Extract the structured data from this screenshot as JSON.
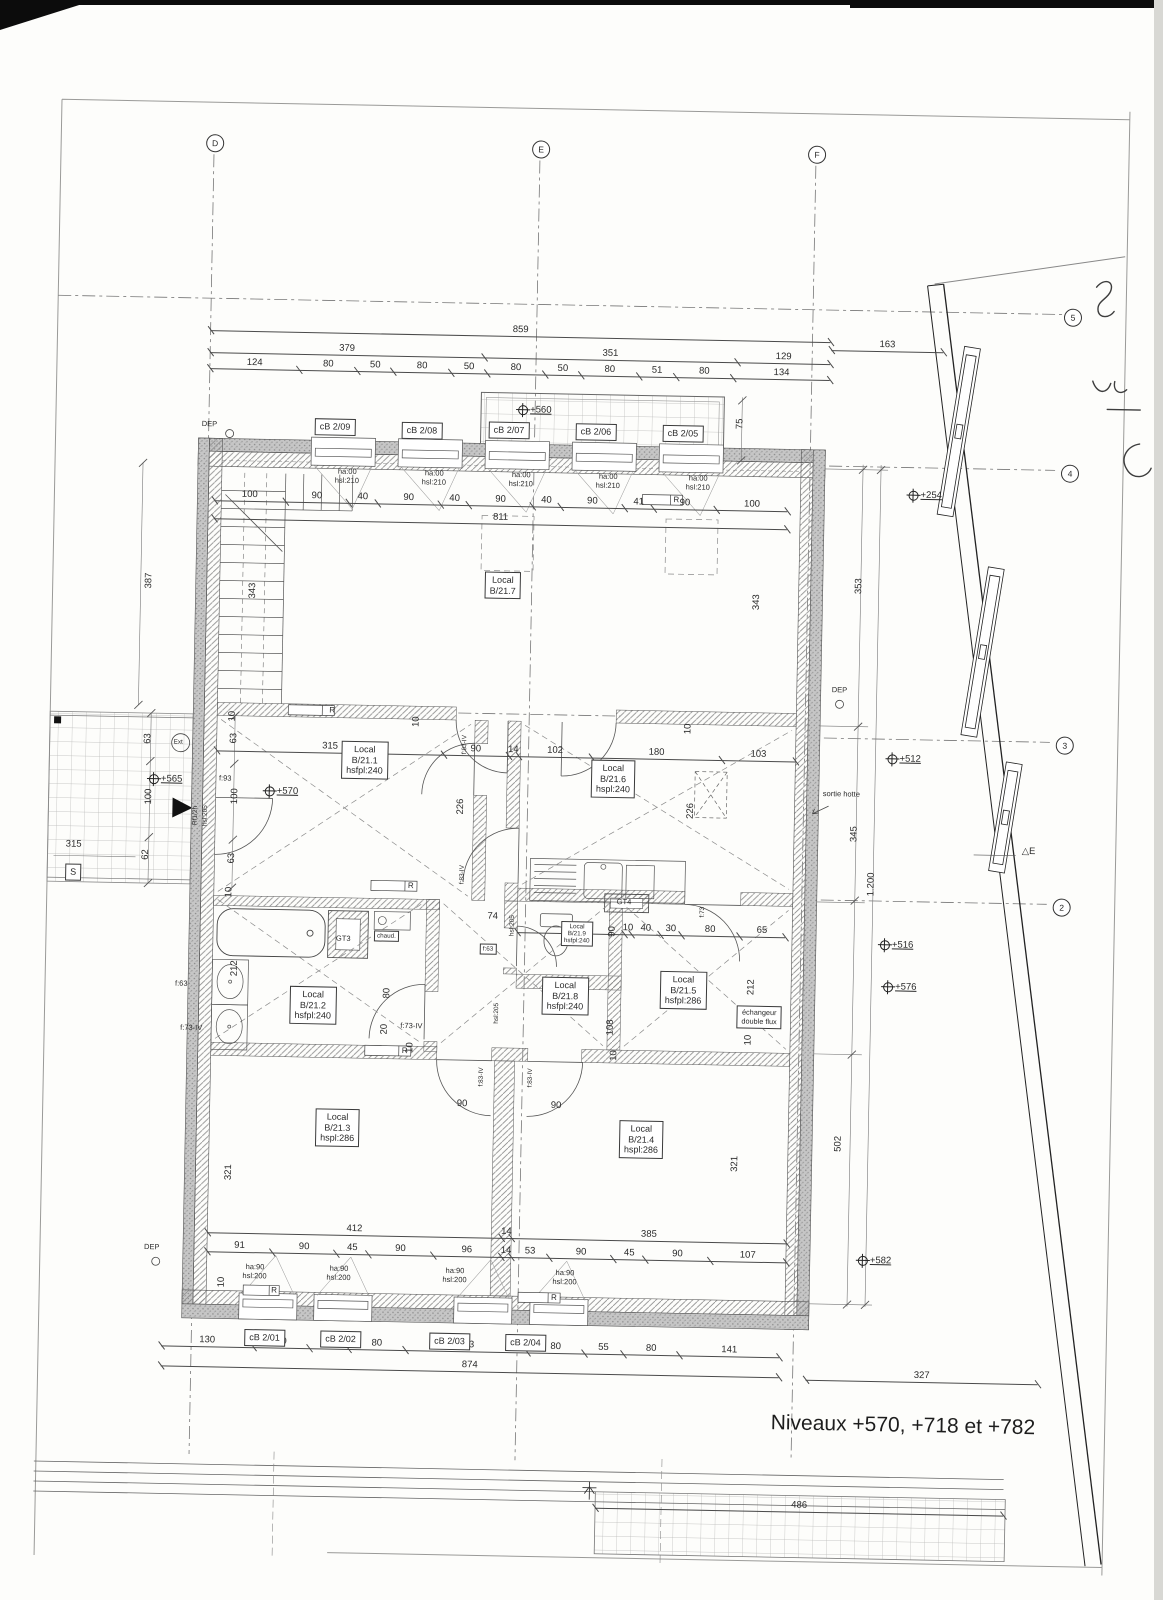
{
  "note": {
    "levels_note": "Niveaux +570, +718 et +782"
  },
  "grid": {
    "d": "D",
    "e": "E",
    "f": "F",
    "r5": "5",
    "r4": "4",
    "r3": "3",
    "r2": "2"
  },
  "levels": {
    "balcony": "+560",
    "facade": "+254",
    "terrace": "+565",
    "entry": "+570",
    "mid": "+512",
    "low1": "+516",
    "low2": "+576",
    "bottom": "+582"
  },
  "rooms": {
    "b217": {
      "l1": "Local",
      "l2": "B/21.7"
    },
    "b211": {
      "l1": "Local",
      "l2": "B/21.1",
      "l3": "hsfpl:240"
    },
    "b216": {
      "l1": "Local",
      "l2": "B/21.6",
      "l3": "hspl:240"
    },
    "b212": {
      "l1": "Local",
      "l2": "B/21.2",
      "l3": "hsfpl:240"
    },
    "b219": {
      "l1": "Local",
      "l2": "B/21.9",
      "l3": "hsfpl:240"
    },
    "b218": {
      "l1": "Local",
      "l2": "B/21.8",
      "l3": "hsfpl:240"
    },
    "b215": {
      "l1": "Local",
      "l2": "B/21.5",
      "l3": "hsfpl:286"
    },
    "b213": {
      "l1": "Local",
      "l2": "B/21.3",
      "l3": "hspl:286"
    },
    "b214": {
      "l1": "Local",
      "l2": "B/21.4",
      "l3": "hspl:286"
    }
  },
  "windows": {
    "top": [
      {
        "id": "cB 2/09",
        "ha": "ha:00",
        "hsl": "hsl:210"
      },
      {
        "id": "cB 2/08",
        "ha": "ha:00",
        "hsl": "hsl:210"
      },
      {
        "id": "cB 2/07",
        "ha": "ha:00",
        "hsl": "hsl:210"
      },
      {
        "id": "cB 2/06",
        "ha": "ha:00",
        "hsl": "hsl:210"
      },
      {
        "id": "cB 2/05",
        "ha": "ha:00",
        "hsl": "hsl:210"
      }
    ],
    "bottom": [
      {
        "id": "cB 2/01",
        "ha": "ha:90",
        "hsl": "hsl:200"
      },
      {
        "id": "cB 2/02",
        "ha": "ha:90",
        "hsl": "hsl:200"
      },
      {
        "id": "cB 2/03",
        "ha": "ha:90",
        "hsl": "hsl:200"
      },
      {
        "id": "cB 2/04",
        "ha": "ha:90",
        "hsl": "hsl:200"
      }
    ]
  },
  "doors": {
    "entry_rating": "Rf1/2h",
    "entry_h": "hsl:205",
    "f93": "f:93",
    "f83": "f:83-IV",
    "f73iv": "f:73-IV",
    "f73": "f:73",
    "f63": "f:63",
    "hsl205": "hsl:205"
  },
  "equipment": {
    "gt3": "GT3",
    "gt4": "GT4",
    "water_heater": "chaud.",
    "hood_outlet": "sortie hotte",
    "exchanger_l1": "échangeur",
    "exchanger_l2": "double flux",
    "radiator": "R",
    "sink_mark": "S",
    "exterior": "Ext",
    "dep": "DEP",
    "east_mark": "△E"
  },
  "dims": {
    "chains": {
      "top_total": [
        "859"
      ],
      "top_spans": [
        "379",
        "351",
        "129"
      ],
      "top_detail": [
        "124",
        "80",
        "50",
        "80",
        "50",
        "80",
        "50",
        "80",
        "51",
        "80",
        "134"
      ],
      "right_offset": [
        "163"
      ],
      "top_wall": [
        "100",
        "90",
        "40",
        "90",
        "40",
        "90",
        "40",
        "90",
        "41",
        "90",
        "100"
      ],
      "top_wall_total": [
        "811"
      ],
      "middle": [
        "315",
        "90",
        "14",
        "102",
        "180",
        "103"
      ],
      "kitchen": [
        "150",
        "10",
        "40",
        "30",
        "80",
        "65"
      ],
      "bottom_rooms": [
        "412",
        "14",
        "385"
      ],
      "bottom_detail": [
        "91",
        "90",
        "45",
        "90",
        "96",
        "14",
        "53",
        "90",
        "45",
        "90",
        "107"
      ],
      "bottom_windows": [
        "130",
        "80",
        "55",
        "80",
        "173",
        "80",
        "55",
        "80",
        "141"
      ],
      "bottom_total": [
        "874"
      ],
      "bottom_right": [
        "327"
      ],
      "lower_band": [
        "486"
      ]
    },
    "v387": "387",
    "v343": "343",
    "v353": "353",
    "v345": "345",
    "v1200": "1.200",
    "v502": "502",
    "v226": "226",
    "v212": "212",
    "v321": "321",
    "v108": "108",
    "v75": "75",
    "v90": "90",
    "v80": "80",
    "v20": "20",
    "v63": "63",
    "v100": "100",
    "v62": "62",
    "v10": "10",
    "h315": "315",
    "d74": "74"
  }
}
